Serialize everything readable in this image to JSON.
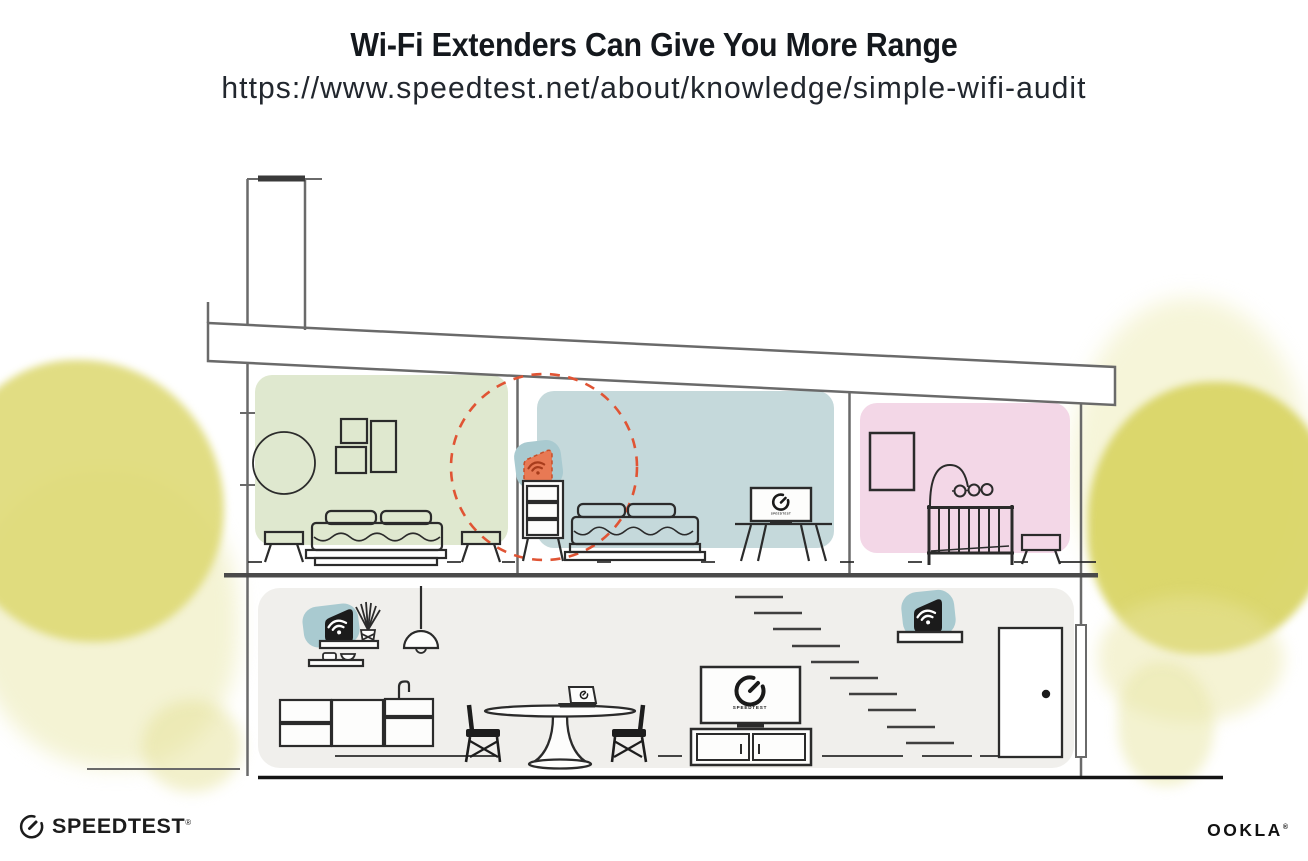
{
  "header": {
    "title": "Wi-Fi Extenders Can Give You More Range",
    "url": "https://www.speedtest.net/about/knowledge/simple-wifi-audit"
  },
  "devices": {
    "tv_screen_label": "SPEEDTEST"
  },
  "footer": {
    "speedtest_label": "SPEEDTEST",
    "speedtest_trademark": "®",
    "ookla_label": "OOKLA",
    "ookla_trademark": "®"
  },
  "icons": {
    "wifi_extender_highlighted": "wifi-extender-orange-icon",
    "wifi_router": "wifi-router-icon",
    "wifi_extender_secondary": "wifi-extender-icon",
    "speedtest_gauge": "speedtest-gauge-icon"
  },
  "colors": {
    "room_green": "#dfe8cf",
    "room_blue": "#c5d9db",
    "room_pink": "#f3d7e7",
    "ground_floor_gray": "#f0efec",
    "device_teal": "#a9cad0",
    "extender_orange": "#e87954",
    "coverage_dashed_red": "#e05434",
    "tree_yellow": "#dfdb7a",
    "furniture_line": "#2b2b2b",
    "structure_line": "#6a6a6a",
    "title_text": "#14181d"
  }
}
